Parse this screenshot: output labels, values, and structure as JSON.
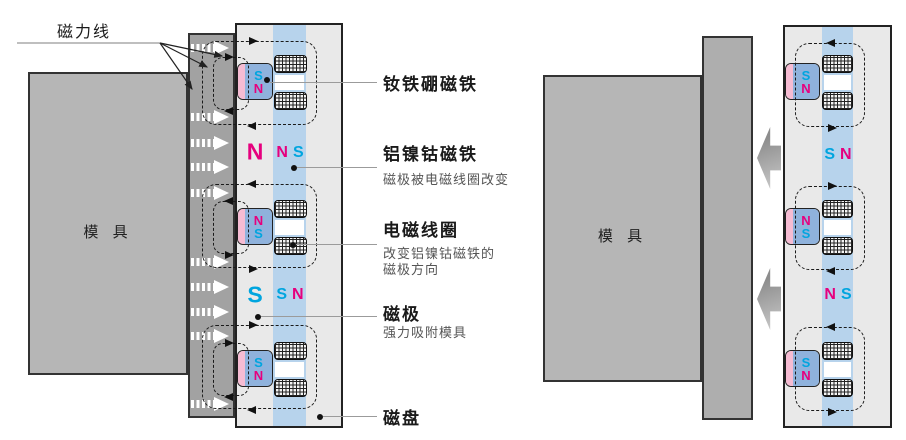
{
  "colors": {
    "magenta": "#e6007e",
    "cyan": "#00a5df",
    "leader": "#9b9b9b"
  },
  "annotations": {
    "field_lines_label": "磁力线",
    "mold_label": "模 具",
    "callouts": [
      {
        "title": "钕铁硼磁铁",
        "subtitle": ""
      },
      {
        "title": "铝镍钴磁铁",
        "subtitle": "磁极被电磁线圈改变"
      },
      {
        "title": "电磁线圈",
        "subtitle": "改变铝镍钴磁铁的\n磁极方向"
      },
      {
        "title": "磁极",
        "subtitle": "强力吸附模具"
      },
      {
        "title": "磁盘",
        "subtitle": ""
      }
    ]
  },
  "left_diagram": {
    "state": "clamped",
    "mold_label": "模 具",
    "pole_big_letters": [
      "N",
      "S"
    ],
    "column_pairs": [
      [
        "N",
        "S"
      ],
      [
        "S",
        "N"
      ]
    ],
    "magnets": [
      {
        "top": "S",
        "bottom": "N"
      },
      {
        "top": "N",
        "bottom": "S"
      },
      {
        "top": "S",
        "bottom": "N"
      }
    ]
  },
  "right_diagram": {
    "state": "released",
    "mold_label": "模 具",
    "column_pairs": [
      [
        "S",
        "N"
      ],
      [
        "N",
        "S"
      ]
    ],
    "magnets": [
      {
        "top": "S",
        "bottom": "N"
      },
      {
        "top": "N",
        "bottom": "S"
      },
      {
        "top": "S",
        "bottom": "N"
      }
    ]
  }
}
